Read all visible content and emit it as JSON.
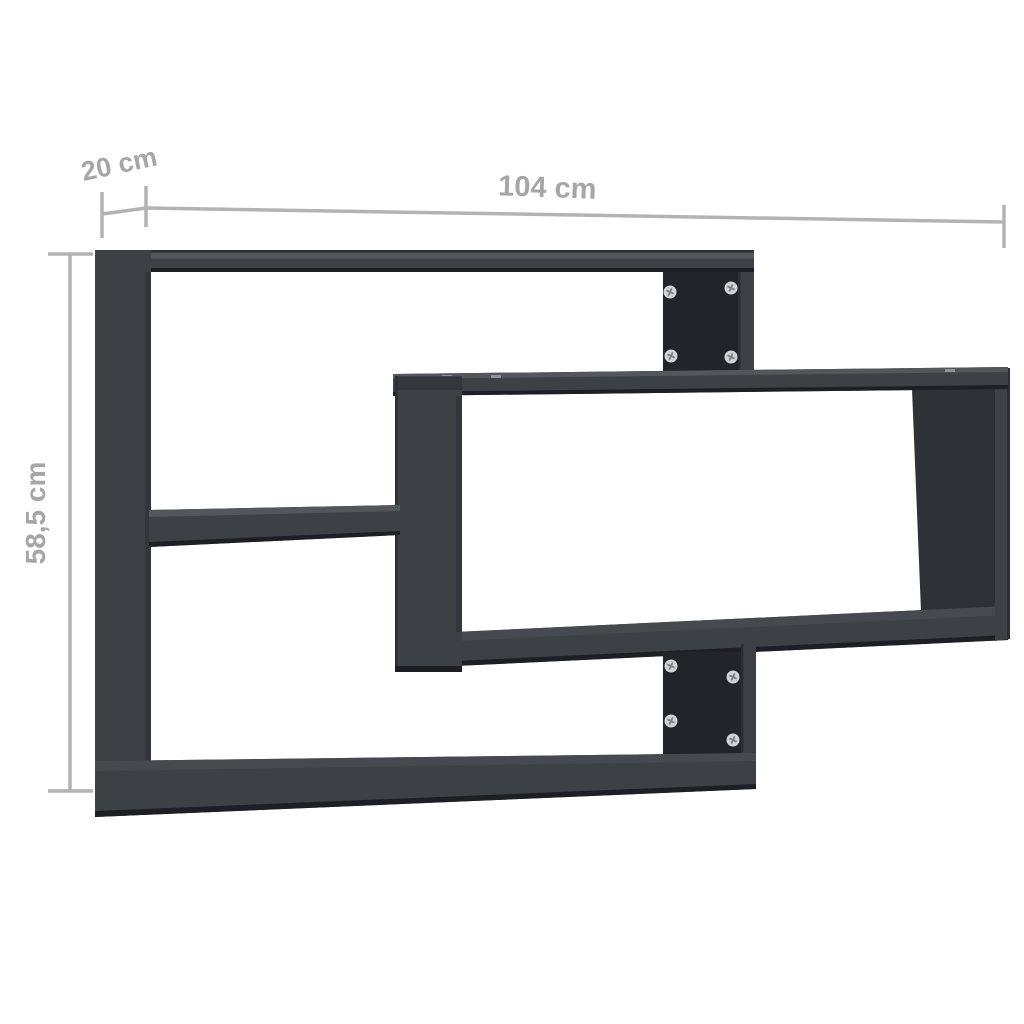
{
  "page": {
    "type": "product dimension diagram",
    "subject": "wall-mounted interlocking rectangle shelf, dark grey",
    "background_color": "#ffffff"
  },
  "dimensions": {
    "depth": {
      "label": "20 cm",
      "value": 20,
      "unit": "cm"
    },
    "width": {
      "label": "104 cm",
      "value": 104,
      "unit": "cm"
    },
    "height": {
      "label": "58,5 cm",
      "value": 58.5,
      "unit": "cm"
    }
  },
  "hardware": {
    "upper_wall_panel_screws": 4,
    "lower_wall_panel_screws": 4
  },
  "style": {
    "page_bg": "#ffffff",
    "shelf_front_color": "#3d4045",
    "shelf_top_color": "#53565b",
    "shelf_top_dim_color": "#46494e",
    "shelf_inner_color": "#2e3136",
    "shelf_shadow_color": "#33363b",
    "shelf_panel_color": "#222429",
    "shelf_edge_color": "#1d1f24",
    "shelf_edge_soft_color": "#2b2e33",
    "shelf_highlight_dash_color": "#90939a",
    "screw_color": "#d2d3d5",
    "screw_slot_color": "#7b7e84",
    "dimension_line_color": "#b3b3b3",
    "dimension_text_color": "#a6a6a6"
  }
}
